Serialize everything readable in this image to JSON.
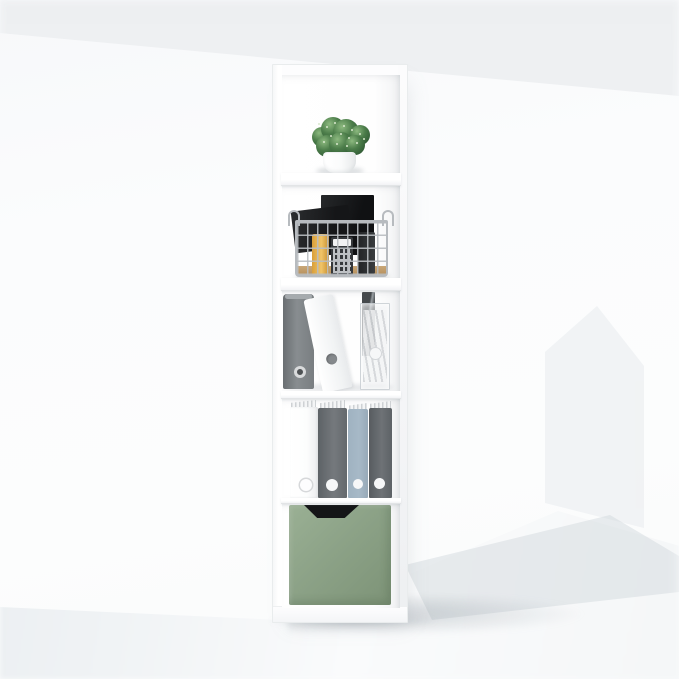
{
  "meta": {
    "type": "product-photo",
    "subject": "Narrow white 5-cube vertical storage bookcase staged with office accessories",
    "setting": "bright white room, soft diagonal light band at top, faint house-shaped shadow on right wall, pale blue-gray floor"
  },
  "colors": {
    "wall": "#fbfcfd",
    "wall-band": "#edeff1",
    "house-shadow": "#f0f2f4",
    "floor-near": "#e9edf0",
    "floor-far": "#fafbfc",
    "shadow-soft": "#cbd2d8",
    "unit": "#fdfdfe",
    "unit-edge": "#e9ebed",
    "board-edge": "#e2e4e6",
    "foliage-light": "#8cb97f",
    "foliage": "#4c7d4a",
    "foliage-dark": "#2c5531",
    "speckle": "#d8e8cd",
    "pot": "#ffffff",
    "pot-shade": "#e7e9ea",
    "wire": "#b7bbbf",
    "bamboo": "#c9a778",
    "tablet": "#1b1d1f",
    "device": "#26282a",
    "book-y1": "#f0c468",
    "book-y2": "#d99f3a",
    "calc-body": "#35383b",
    "calc-top": "#f1f2f3",
    "key": "#d7dadc",
    "binder-dark-1": "#6a6f72",
    "binder-dark-2": "#888d90",
    "binder-white": "#fcfdfd",
    "sheet-dark": "#4a4e51",
    "acrylic": "#eff1f3",
    "paper": "#f4f5f6",
    "paper-edge": "#ced1d4",
    "file-white": "#fcfdfd",
    "file-dark": "#64696d",
    "file-dark2": "#5d6266",
    "file-blue": "#a7b9c7",
    "hole-white": "#f6f7f8",
    "ring-gray": "#85898c",
    "sage-1": "#9ab094",
    "sage-2": "#8ca287",
    "sage-3": "#7d9377",
    "cutout": "#141517"
  },
  "shelf_unit": {
    "cube_count": 5,
    "material": "white laminate",
    "cubes": [
      {
        "position": 1,
        "contents": [
          "artificial green plant in round white pot"
        ]
      },
      {
        "position": 2,
        "contents": [
          "chrome wire storage basket with bamboo base",
          "black tablet standing upright",
          "tilted black device",
          "yellow notebook spine",
          "calculator with keypad",
          "black charger"
        ]
      },
      {
        "position": 3,
        "contents": [
          "gray lever-arch binder upright",
          "white lever-arch binder leaning left",
          "clear acrylic file box with papers",
          "dark glossy folder"
        ]
      },
      {
        "position": 4,
        "contents": [
          "white magazine file",
          "dark gray magazine file",
          "blue-gray magazine file",
          "dark gray magazine file",
          "paper stacks on top of each file"
        ]
      },
      {
        "position": 5,
        "contents": [
          "sage green fabric drawer bin with trapezoid cutout handle"
        ]
      }
    ]
  }
}
